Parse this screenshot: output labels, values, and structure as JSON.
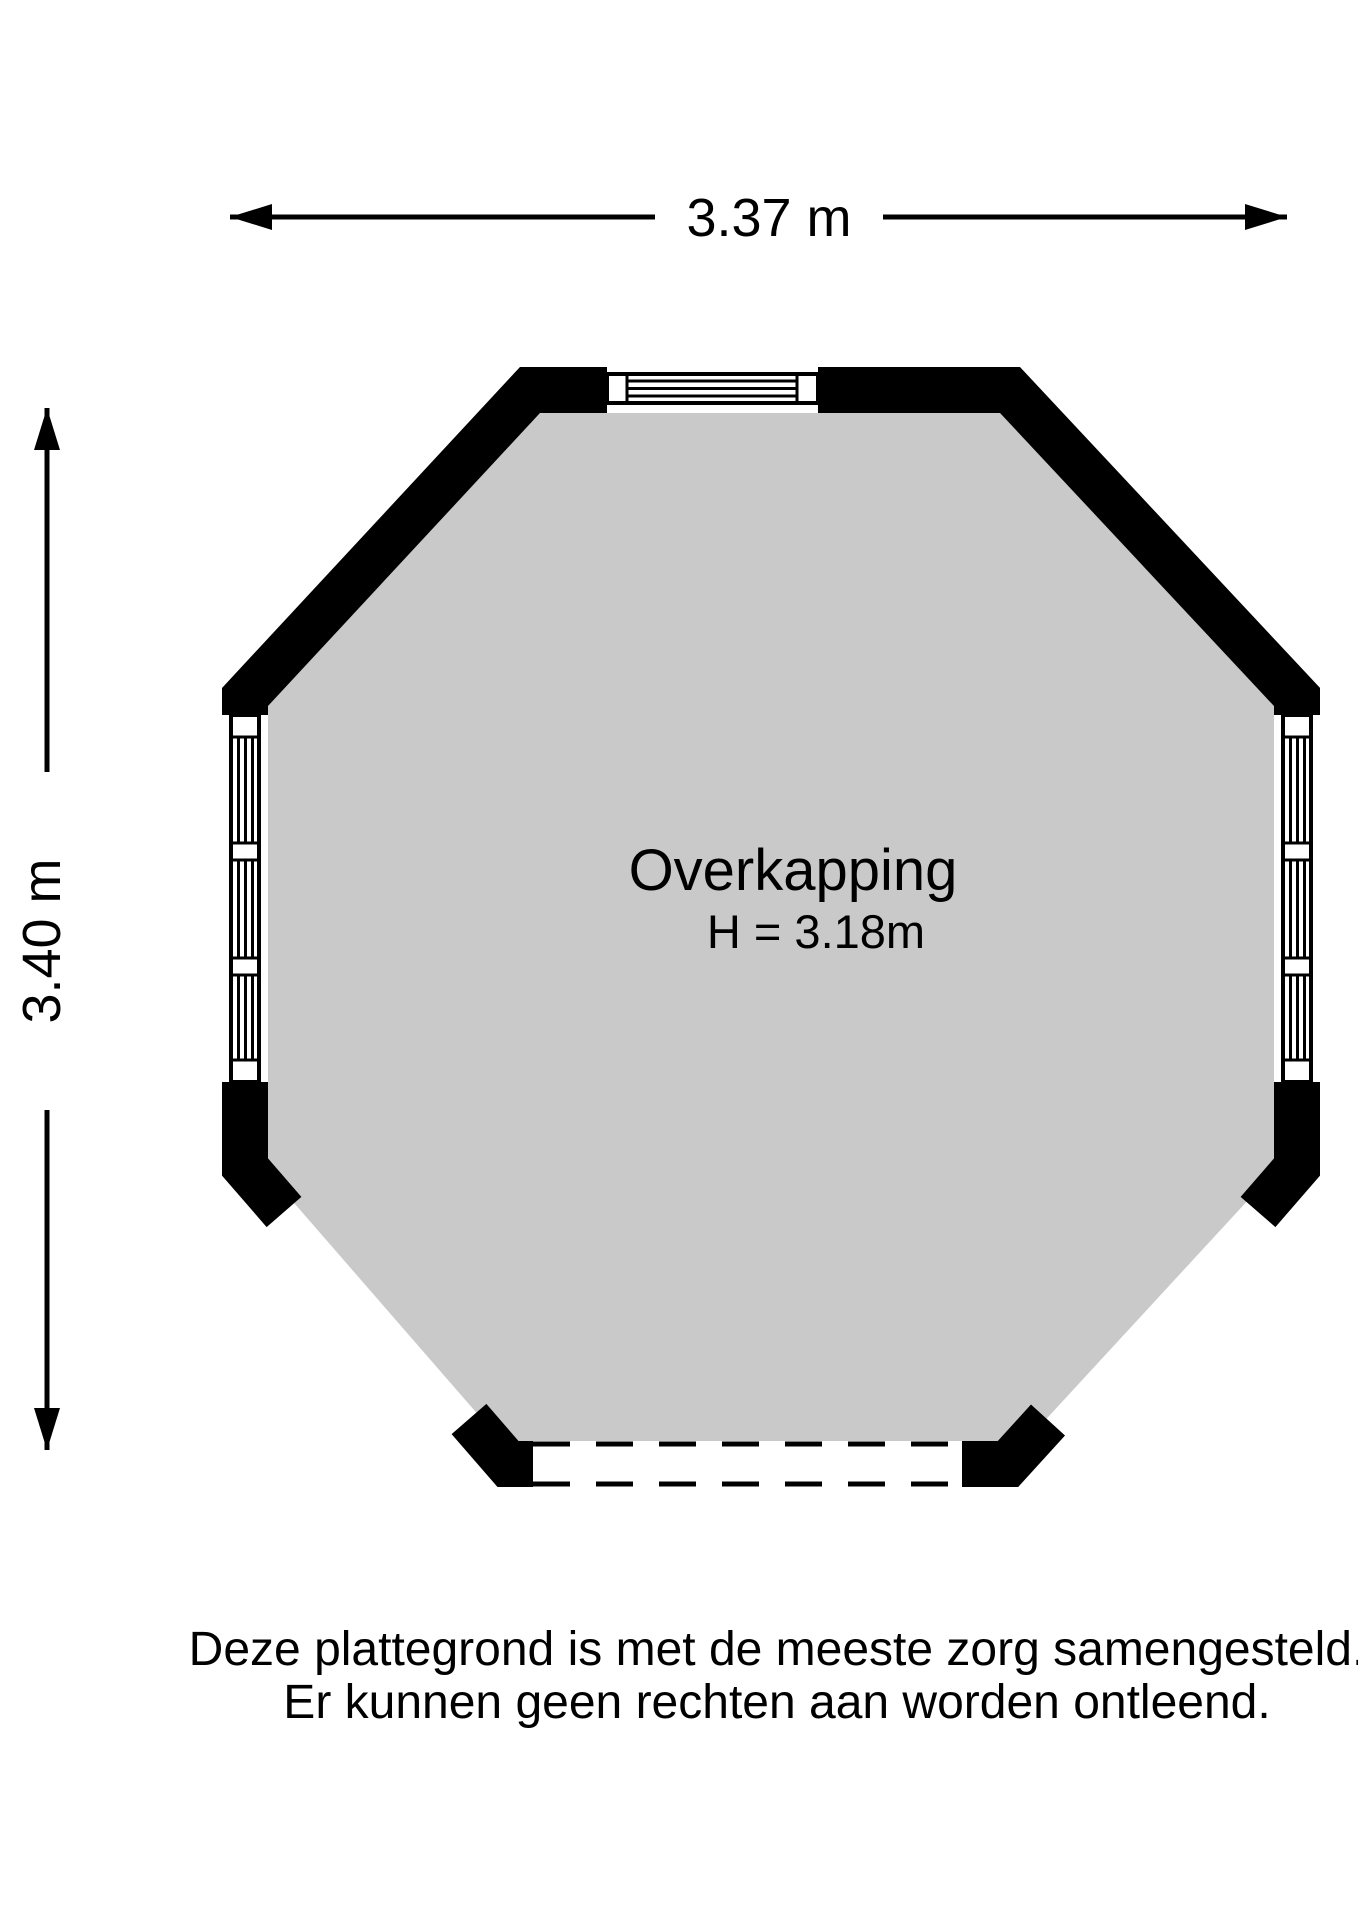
{
  "room": {
    "name": "Overkapping",
    "height_label": "H = 3.18m"
  },
  "dimensions": {
    "width_label": "3.37 m",
    "height_label": "3.40 m"
  },
  "disclaimer": {
    "line1": "Deze plattegrond is met de meeste zorg samengesteld.",
    "line2": "Er kunnen geen rechten aan worden ontleend."
  },
  "colors": {
    "floor": "#c9c9c9",
    "wall": "#000000",
    "line": "#000000",
    "background": "#ffffff"
  }
}
